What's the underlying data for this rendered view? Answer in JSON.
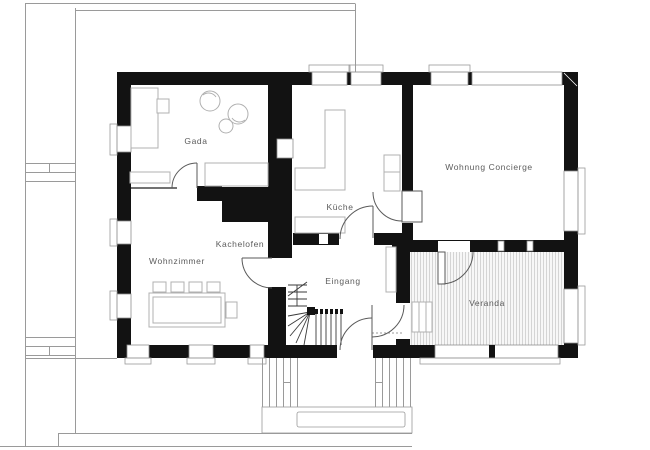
{
  "drawing": {
    "type": "architectural-floor-plan",
    "floor": "ground-floor"
  },
  "rooms": {
    "gada": {
      "label": "Gada"
    },
    "wohnzimmer": {
      "label": "Wohnzimmer"
    },
    "kachelofen": {
      "label": "Kachelofen"
    },
    "kueche": {
      "label": "Küche"
    },
    "eingang": {
      "label": "Eingang"
    },
    "concierge": {
      "label": "Wohnung Concierge"
    },
    "veranda": {
      "label": "Veranda"
    }
  },
  "colors": {
    "wall": "#121212",
    "background": "#ffffff",
    "label_text": "#5c5c5c",
    "furniture_line": "#b0b0b0",
    "veranda_hatch": "#c6c6c6",
    "site_line": "#9a9a9a"
  }
}
